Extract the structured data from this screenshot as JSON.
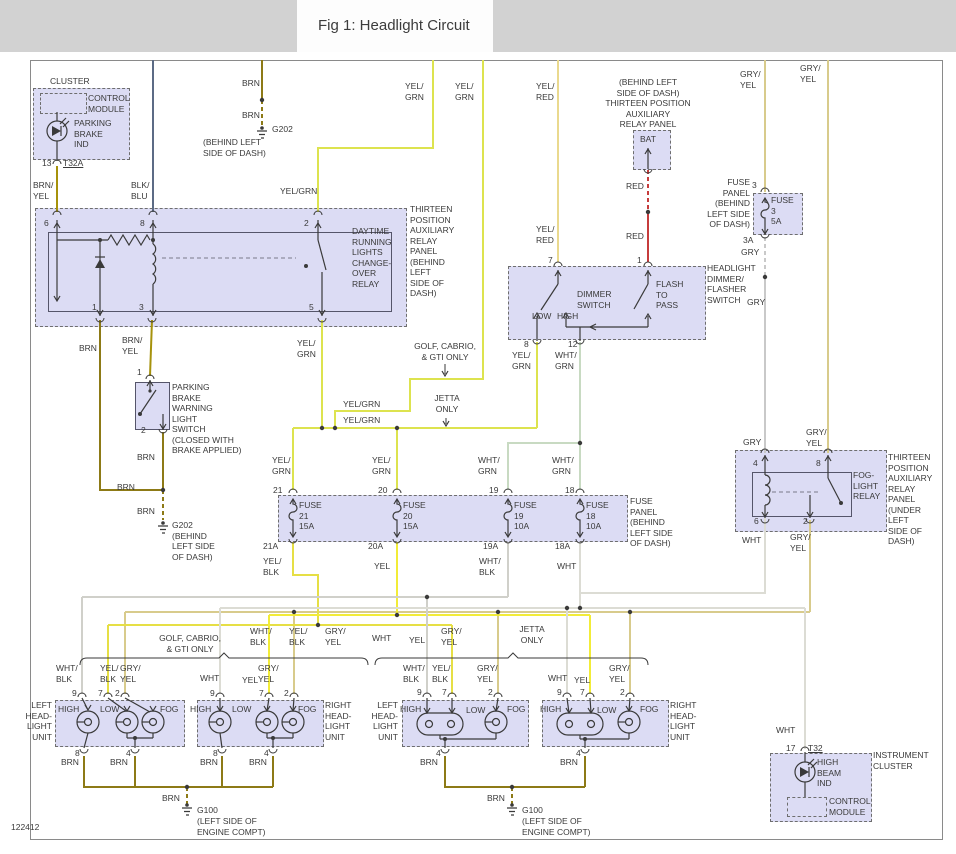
{
  "title": "Fig 1: Headlight Circuit",
  "doc_number": "122412",
  "colors": {
    "panel_fill": "#dcdcf4",
    "title_bar": "#d2d2d2",
    "wire_brn": "#8d7a16",
    "wire_brn_yel": "#a6920c",
    "wire_blk_blu": "#5c6b85",
    "wire_yel_grn": "#dde34f",
    "wire_yel": "#f2ec38",
    "wire_yel_blk": "#e6df45",
    "wire_yel_red": "#ead98e",
    "wire_red": "#c63c3c",
    "wire_gry": "#c9c9c9",
    "wire_gry_yel": "#d8cb8c",
    "wire_wht_grn": "#c8dac2",
    "wire_wht_blk": "#d0d0ca",
    "wire_wht": "#dcdcd4"
  },
  "wire": {
    "brn": "BRN",
    "brn_yel": "BRN/\nYEL",
    "blk_blu": "BLK/\nBLU",
    "yel_grn": "YEL/\nGRN",
    "yel_grn1": "YEL/GRN",
    "yel_red": "YEL/\nRED",
    "red": "RED",
    "gry": "GRY",
    "gry_yel": "GRY/\nYEL",
    "wht": "WHT",
    "wht_grn": "WHT/\nGRN",
    "wht_blk": "WHT/\nBLK",
    "yel_blk": "YEL/\nBLK",
    "yel": "YEL"
  },
  "pin": {
    "p1": "1",
    "p2": "2",
    "p3": "3",
    "p4": "4",
    "p5": "5",
    "p6": "6",
    "p7": "7",
    "p8": "8",
    "p9": "9",
    "p12": "12",
    "p13": "13",
    "p17": "17",
    "p3f": "3",
    "p3a": "3A",
    "p18": "18",
    "p18a": "18A",
    "p19": "19",
    "p19a": "19A",
    "p20": "20",
    "p20a": "20A",
    "p21": "21",
    "p21a": "21A",
    "t32": "T32",
    "t32a": "T32A"
  },
  "cluster": {
    "name": "CLUSTER",
    "control_module": "CONTROL\nMODULE",
    "parking_brake_ind": "PARKING\nBRAKE\nIND"
  },
  "drl": {
    "label": "DAYTIME\nRUNNING\nLIGHTS\nCHANGE-\nOVER\nRELAY",
    "panel": "THIRTEEN\nPOSITION\nAUXILIARY\nRELAY\nPANEL\n(BEHIND\nLEFT\nSIDE OF\nDASH)"
  },
  "bat": {
    "panel": "(BEHIND LEFT\nSIDE OF DASH)\nTHIRTEEN POSITION\nAUXILIARY\nRELAY PANEL",
    "label": "BAT"
  },
  "dimmer": {
    "label": "DIMMER\nSWITCH",
    "low": "LOW",
    "high": "HIGH",
    "flash": "FLASH\nTO\nPASS",
    "name": "HEADLIGHT\nDIMMER/\nFLASHER\nSWITCH"
  },
  "fuse3": {
    "panel": "FUSE\nPANEL\n(BEHIND\nLEFT SIDE\nOF DASH)",
    "label": "FUSE\n3\n5A"
  },
  "fog": {
    "label": "FOG-\nLIGHT\nRELAY",
    "panel": "THIRTEEN\nPOSITION\nAUXILIARY\nRELAY\nPANEL\n(UNDER\nLEFT\nSIDE OF\nDASH)"
  },
  "fuse_panel": {
    "label": "FUSE\nPANEL\n(BEHIND\nLEFT SIDE\nOF DASH)",
    "f21": "FUSE\n21\n15A",
    "f20": "FUSE\n20\n15A",
    "f19": "FUSE\n19\n10A",
    "f18": "FUSE\n18\n10A"
  },
  "pbs": {
    "label": "PARKING\nBRAKE\nWARNING\nLIGHT\nSWITCH\n(CLOSED WITH\nBRAKE APPLIED)"
  },
  "variants": {
    "golf": "GOLF, CABRIO,\n& GTI ONLY",
    "jetta": "JETTA\nONLY"
  },
  "units": {
    "left": "LEFT\nHEAD-\nLIGHT\nUNIT",
    "right": "RIGHT\nHEAD-\nLIGHT\nUNIT",
    "high": "HIGH",
    "low": "LOW",
    "fog": "FOG"
  },
  "grounds": {
    "g202": "G202",
    "g202_loc": "(BEHIND LEFT\nSIDE OF DASH)",
    "g202_b": "G202\n(BEHIND\nLEFT SIDE\nOF DASH)",
    "g100": "G100",
    "g100_loc": "(LEFT SIDE OF\nENGINE COMPT)"
  },
  "ic": {
    "name": "INSTRUMENT\nCLUSTER",
    "high_beam": "HIGH\nBEAM\nIND",
    "control_module": "CONTROL\nMODULE"
  }
}
